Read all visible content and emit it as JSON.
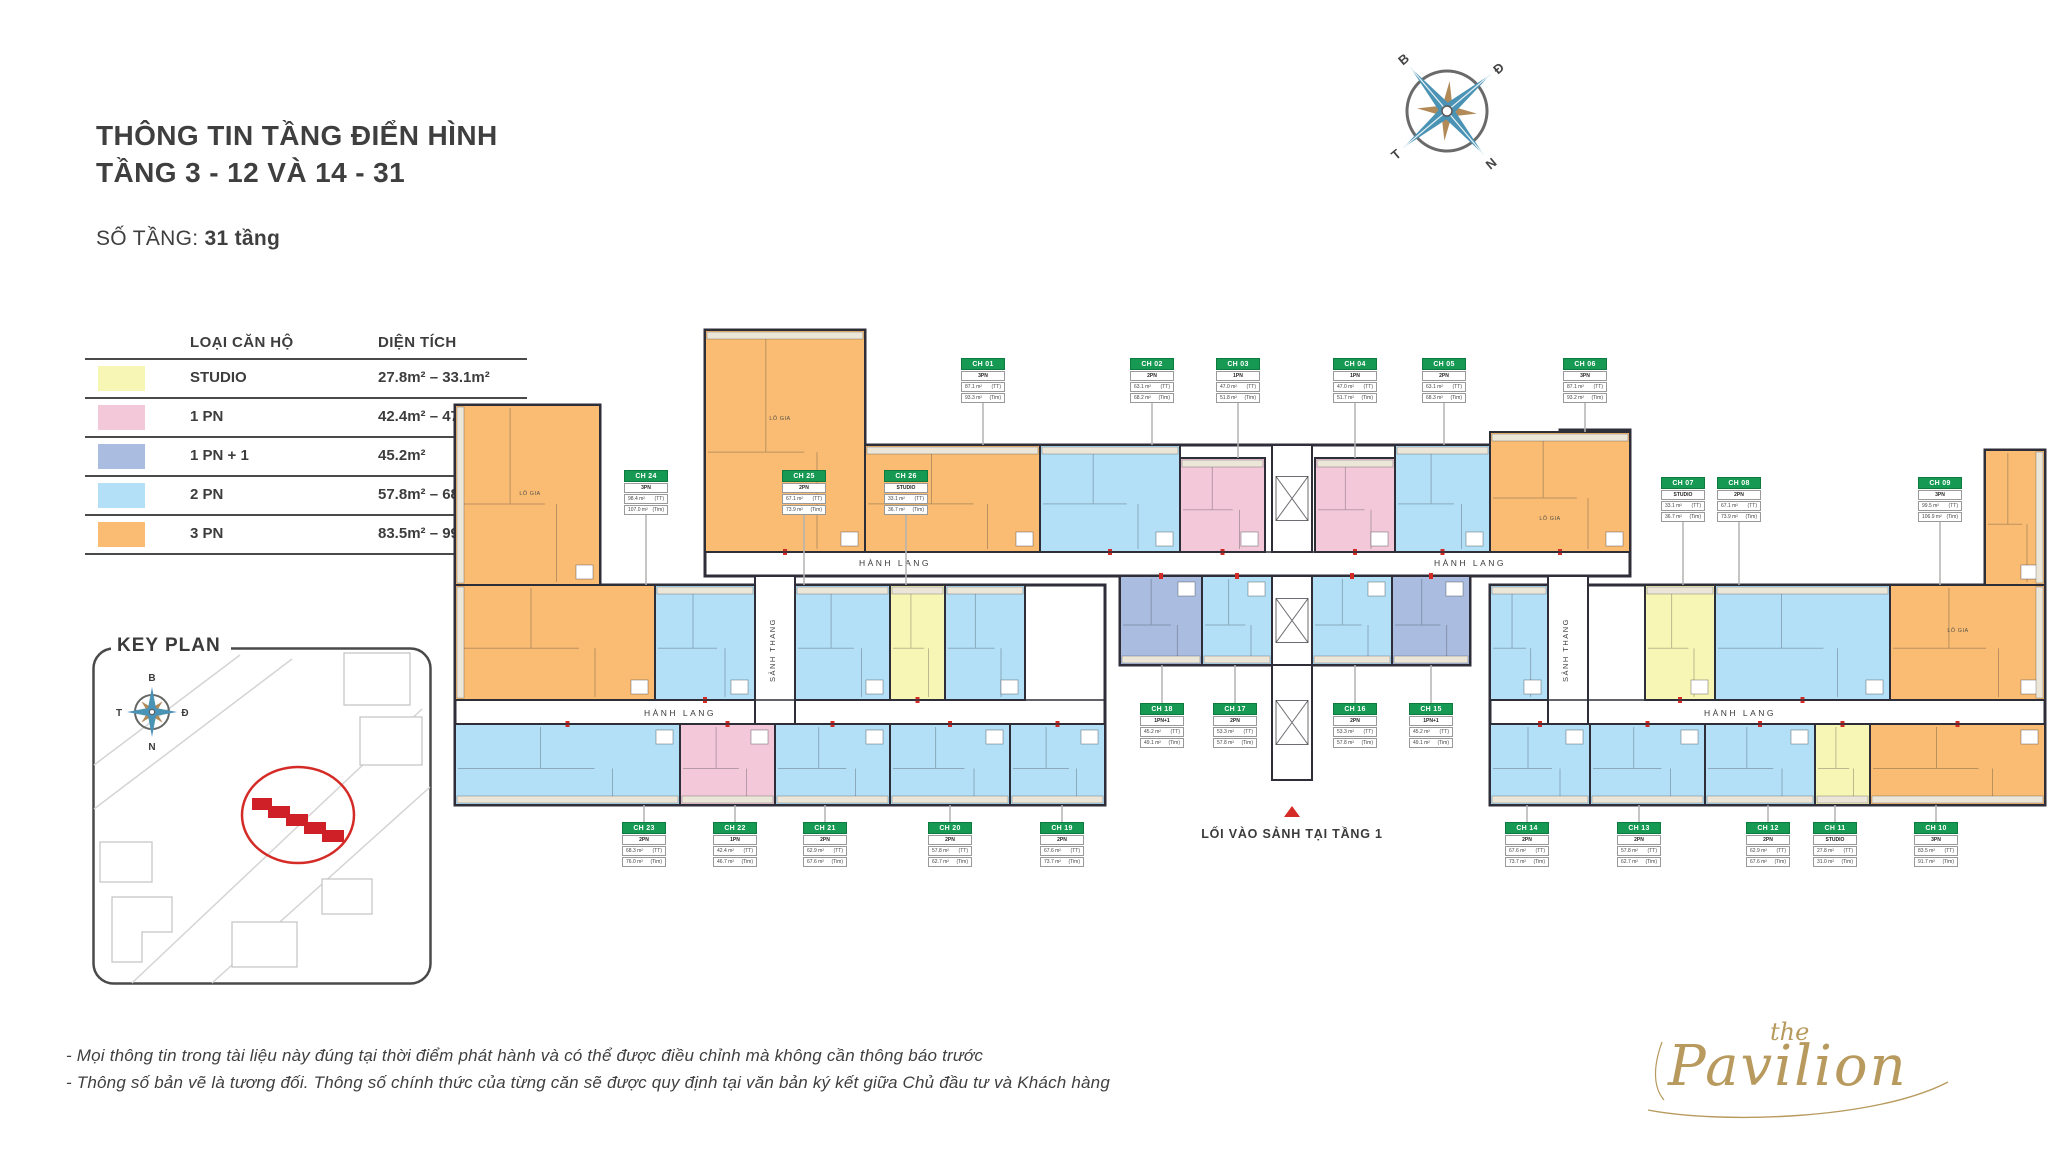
{
  "page": {
    "title_line1": "THÔNG TIN TẦNG ĐIỂN HÌNH",
    "title_line2": "TẦNG 3 - 12 VÀ 14 - 31",
    "floors_label": "SỐ TẦNG:",
    "floors_value": "31 tầng"
  },
  "legend": {
    "col_type": "LOẠI CĂN HỘ",
    "col_area": "DIỆN TÍCH",
    "rows": [
      {
        "type": "STUDIO",
        "area": "27.8m² – 33.1m²",
        "color": "#f8f6b4"
      },
      {
        "type": "1 PN",
        "area": "42.4m² – 47m²",
        "color": "#f3c9d9"
      },
      {
        "type": "1 PN + 1",
        "area": "45.2m²",
        "color": "#aabde0"
      },
      {
        "type": "2 PN",
        "area": "57.8m² – 68.3m²",
        "color": "#b3e0f7"
      },
      {
        "type": "3 PN",
        "area": "83.5m² – 99.5m²",
        "color": "#f9bc72"
      }
    ]
  },
  "key_plan": {
    "title": "KEY PLAN",
    "compass": {
      "n": "B",
      "e": "Đ",
      "s": "N",
      "w": "T"
    }
  },
  "compass": {
    "n": "B",
    "e": "Đ",
    "s": "N",
    "w": "T"
  },
  "plan": {
    "wall": "#2e2e38",
    "colors": {
      "STUDIO": "#f8f6b4",
      "1PN": "#f3c9d9",
      "1PN+1": "#aabde0",
      "2PN": "#b3e0f7",
      "3PN": "#f9bc72"
    },
    "labels": {
      "corridor": "HÀNH LANG",
      "stair": "SẢNH THANG",
      "entry": "LỐI VÀO SẢNH TẠI TẦNG 1",
      "balcony": "LÔ GIA",
      "tt_suffix": "(TT)",
      "tim_suffix": "(Tim)"
    },
    "outlines": [
      "705,330 865,330 865,445 1560,445 1560,430 1630,430 1630,576 705,576",
      "455,405 600,405 600,585 1105,585 1105,805 455,805",
      "1490,585 1985,585 1985,450 2045,450 2045,805 1490,805",
      "1120,576 1470,576 1470,665 1120,665"
    ],
    "stair_wells": [
      [
        755,
        576,
        40,
        148
      ],
      [
        1548,
        576,
        40,
        148
      ]
    ],
    "cores": [
      [
        1272,
        445,
        40,
        107
      ],
      [
        1272,
        576,
        40,
        89
      ]
    ],
    "lobby": [
      1272,
      665,
      40,
      115
    ],
    "corridor_texts": [
      [
        895,
        566
      ],
      [
        1470,
        566
      ],
      [
        680,
        716
      ],
      [
        1740,
        716
      ]
    ],
    "stair_texts": [
      [
        775,
        650
      ],
      [
        1568,
        650
      ]
    ],
    "entry_pos": {
      "triangle": "1284,817 1300,817 1292,806",
      "text_x": 1292,
      "text_y": 838
    },
    "balcony_labels": [
      [
        530,
        495
      ],
      [
        780,
        420
      ],
      [
        1550,
        520
      ],
      [
        1958,
        632
      ]
    ],
    "fills": [
      {
        "type": "2PN",
        "r": [
          945,
          585,
          80,
          115
        ]
      },
      {
        "type": "2PN",
        "r": [
          1490,
          585,
          58,
          115
        ]
      }
    ],
    "units": [
      {
        "id": "CH 01",
        "type": "3PN",
        "tt": "87.1 m²",
        "tim": "93.3 m²",
        "card": [
          983,
          358
        ],
        "line": [
          983,
          400,
          445
        ],
        "rects": [
          [
            705,
            330,
            160,
            222
          ],
          [
            865,
            445,
            175,
            107
          ]
        ],
        "bal": "top"
      },
      {
        "id": "CH 02",
        "type": "2PN",
        "tt": "63.1 m²",
        "tim": "68.2 m²",
        "card": [
          1152,
          358
        ],
        "line": [
          1152,
          400,
          445
        ],
        "rects": [
          [
            1040,
            445,
            140,
            107
          ]
        ],
        "bal": "top"
      },
      {
        "id": "CH 03",
        "type": "1PN",
        "tt": "47.0 m²",
        "tim": "51.8 m²",
        "card": [
          1238,
          358
        ],
        "line": [
          1238,
          400,
          458
        ],
        "rects": [
          [
            1180,
            458,
            85,
            94
          ]
        ],
        "bal": "top"
      },
      {
        "id": "CH 04",
        "type": "1PN",
        "tt": "47.0 m²",
        "tim": "51.7 m²",
        "card": [
          1355,
          358
        ],
        "line": [
          1355,
          400,
          458
        ],
        "rects": [
          [
            1315,
            458,
            80,
            94
          ]
        ],
        "bal": "top"
      },
      {
        "id": "CH 05",
        "type": "2PN",
        "tt": "63.1 m²",
        "tim": "68.3 m²",
        "card": [
          1444,
          358
        ],
        "line": [
          1444,
          400,
          445
        ],
        "rects": [
          [
            1395,
            445,
            95,
            107
          ]
        ],
        "bal": "top"
      },
      {
        "id": "CH 06",
        "type": "3PN",
        "tt": "87.1 m²",
        "tim": "93.2 m²",
        "card": [
          1585,
          358
        ],
        "line": [
          1585,
          400,
          432
        ],
        "rects": [
          [
            1490,
            432,
            140,
            120
          ]
        ],
        "bal": "top"
      },
      {
        "id": "CH 07",
        "type": "STUDIO",
        "tt": "33.1 m²",
        "tim": "36.7 m²",
        "card": [
          1683,
          477
        ],
        "line": [
          1683,
          519,
          585
        ],
        "rects": [
          [
            1645,
            585,
            70,
            115
          ]
        ],
        "bal": "top"
      },
      {
        "id": "CH 08",
        "type": "2PN",
        "tt": "67.1 m²",
        "tim": "73.9 m²",
        "card": [
          1739,
          477
        ],
        "line": [
          1739,
          519,
          585
        ],
        "rects": [
          [
            1715,
            585,
            175,
            115
          ]
        ],
        "bal": "top"
      },
      {
        "id": "CH 09",
        "type": "3PN",
        "tt": "99.5 m²",
        "tim": "106.9 m²",
        "card": [
          1940,
          477
        ],
        "line": [
          1940,
          519,
          585
        ],
        "rects": [
          [
            1985,
            450,
            60,
            135
          ],
          [
            1890,
            585,
            155,
            115
          ]
        ],
        "bal": "right"
      },
      {
        "id": "CH 10",
        "type": "3PN",
        "tt": "83.5 m²",
        "tim": "91.7 m²",
        "card": [
          1936,
          822
        ],
        "line": [
          1936,
          805,
          822
        ],
        "rects": [
          [
            1870,
            724,
            175,
            81
          ]
        ],
        "bal": "bottom"
      },
      {
        "id": "CH 11",
        "type": "STUDIO",
        "tt": "27.8 m²",
        "tim": "31.0 m²",
        "card": [
          1835,
          822
        ],
        "line": [
          1835,
          805,
          822
        ],
        "rects": [
          [
            1815,
            724,
            55,
            81
          ]
        ],
        "bal": "bottom"
      },
      {
        "id": "CH 12",
        "type": "2PN",
        "tt": "62.9 m²",
        "tim": "67.6 m²",
        "card": [
          1768,
          822
        ],
        "line": [
          1768,
          805,
          822
        ],
        "rects": [
          [
            1705,
            724,
            110,
            81
          ]
        ],
        "bal": "bottom"
      },
      {
        "id": "CH 13",
        "type": "2PN",
        "tt": "57.8 m²",
        "tim": "62.7 m²",
        "card": [
          1639,
          822
        ],
        "line": [
          1639,
          805,
          822
        ],
        "rects": [
          [
            1590,
            724,
            115,
            81
          ]
        ],
        "bal": "bottom"
      },
      {
        "id": "CH 14",
        "type": "2PN",
        "tt": "67.6 m²",
        "tim": "73.7 m²",
        "card": [
          1527,
          822
        ],
        "line": [
          1527,
          805,
          822
        ],
        "rects": [
          [
            1490,
            724,
            100,
            81
          ]
        ],
        "bal": "bottom"
      },
      {
        "id": "CH 15",
        "type": "1PN+1",
        "tt": "45.2 m²",
        "tim": "49.1 m²",
        "card": [
          1431,
          703
        ],
        "line": [
          1431,
          665,
          703
        ],
        "rects": [
          [
            1392,
            576,
            78,
            89
          ]
        ],
        "bal": "bottom"
      },
      {
        "id": "CH 16",
        "type": "2PN",
        "tt": "53.3 m²",
        "tim": "57.8 m²",
        "card": [
          1355,
          703
        ],
        "line": [
          1355,
          665,
          703
        ],
        "rects": [
          [
            1312,
            576,
            80,
            89
          ]
        ],
        "bal": "bottom"
      },
      {
        "id": "CH 17",
        "type": "2PN",
        "tt": "53.3 m²",
        "tim": "57.8 m²",
        "card": [
          1235,
          703
        ],
        "line": [
          1235,
          665,
          703
        ],
        "rects": [
          [
            1202,
            576,
            70,
            89
          ]
        ],
        "bal": "bottom"
      },
      {
        "id": "CH 18",
        "type": "1PN+1",
        "tt": "45.2 m²",
        "tim": "49.1 m²",
        "card": [
          1162,
          703
        ],
        "line": [
          1162,
          665,
          703
        ],
        "rects": [
          [
            1120,
            576,
            82,
            89
          ]
        ],
        "bal": "bottom"
      },
      {
        "id": "CH 19",
        "type": "2PN",
        "tt": "67.6 m²",
        "tim": "73.7 m²",
        "card": [
          1062,
          822
        ],
        "line": [
          1062,
          805,
          822
        ],
        "rects": [
          [
            1010,
            724,
            95,
            81
          ]
        ],
        "bal": "bottom"
      },
      {
        "id": "CH 20",
        "type": "2PN",
        "tt": "57.8 m²",
        "tim": "62.7 m²",
        "card": [
          950,
          822
        ],
        "line": [
          950,
          805,
          822
        ],
        "rects": [
          [
            890,
            724,
            120,
            81
          ]
        ],
        "bal": "bottom"
      },
      {
        "id": "CH 21",
        "type": "2PN",
        "tt": "62.9 m²",
        "tim": "67.6 m²",
        "card": [
          825,
          822
        ],
        "line": [
          825,
          805,
          822
        ],
        "rects": [
          [
            775,
            724,
            115,
            81
          ]
        ],
        "bal": "bottom"
      },
      {
        "id": "CH 22",
        "type": "1PN",
        "tt": "42.4 m²",
        "tim": "46.7 m²",
        "card": [
          735,
          822
        ],
        "line": [
          735,
          805,
          822
        ],
        "rects": [
          [
            680,
            724,
            95,
            81
          ]
        ],
        "bal": "bottom"
      },
      {
        "id": "CH 23",
        "type": "2PN",
        "tt": "68.3 m²",
        "tim": "76.0 m²",
        "card": [
          644,
          822
        ],
        "line": [
          644,
          805,
          822
        ],
        "rects": [
          [
            455,
            724,
            225,
            81
          ]
        ],
        "bal": "bottom"
      },
      {
        "id": "CH 24",
        "type": "3PN",
        "tt": "98.4 m²",
        "tim": "107.0 m²",
        "card": [
          646,
          470
        ],
        "line": [
          646,
          512,
          585
        ],
        "rects": [
          [
            455,
            405,
            145,
            180
          ],
          [
            455,
            585,
            200,
            115
          ]
        ],
        "bal": "left"
      },
      {
        "id": "CH 25",
        "type": "2PN",
        "tt": "67.1 m²",
        "tim": "73.9 m²",
        "card": [
          804,
          470
        ],
        "line": [
          804,
          512,
          585
        ],
        "rects": [
          [
            655,
            585,
            100,
            115
          ],
          [
            795,
            585,
            95,
            115
          ]
        ],
        "bal": "top"
      },
      {
        "id": "CH 26",
        "type": "STUDIO",
        "tt": "33.1 m²",
        "tim": "36.7 m²",
        "card": [
          906,
          470
        ],
        "line": [
          906,
          512,
          585
        ],
        "rects": [
          [
            890,
            585,
            55,
            115
          ]
        ],
        "bal": "top"
      }
    ]
  },
  "footer": {
    "note1": "- Mọi thông tin trong tài liệu này đúng tại thời điểm phát hành và có thể được điều chỉnh mà không cần thông báo trước",
    "note2": "- Thông số bản vẽ là tương đối. Thông số chính thức của từng căn sẽ được quy định tại văn bản ký kết giữa Chủ đầu tư và Khách hàng"
  },
  "logo": {
    "the": "the",
    "name": "Pavilion"
  }
}
